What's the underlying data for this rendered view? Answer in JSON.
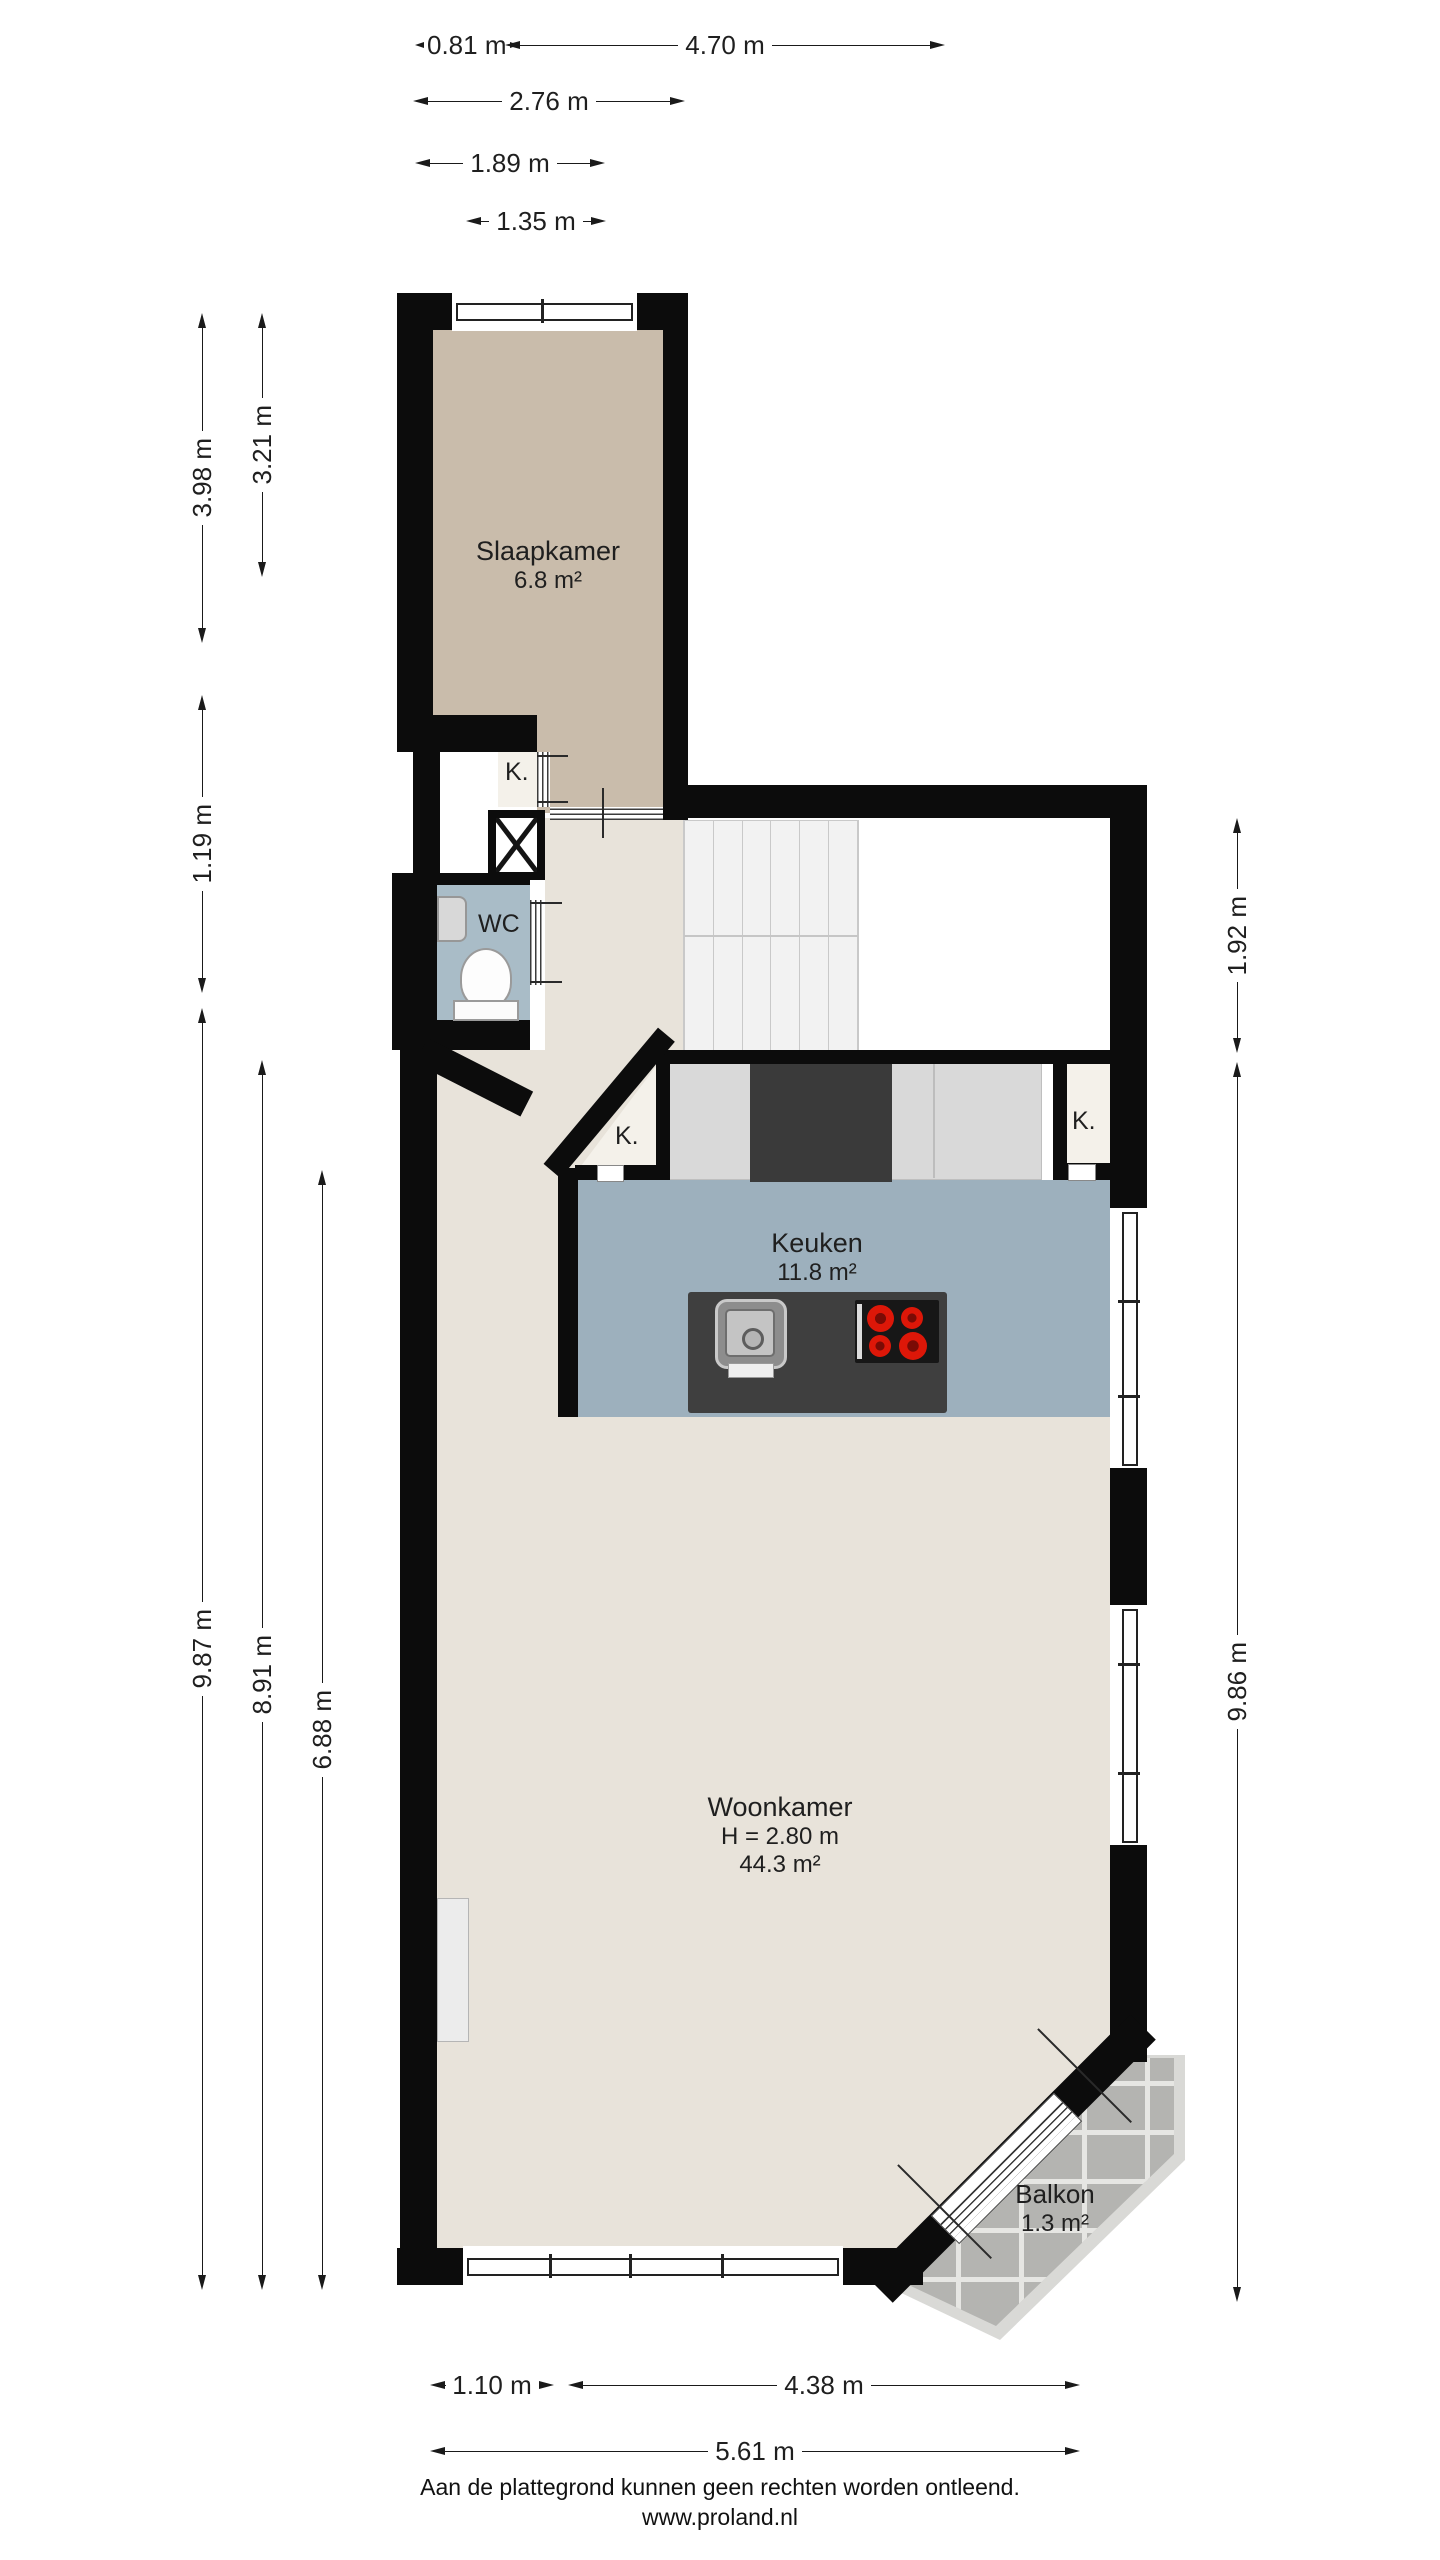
{
  "rooms": {
    "slaapkamer": {
      "name": "Slaapkamer",
      "area": "6.8 m²"
    },
    "wc": {
      "name": "WC"
    },
    "keuken": {
      "name": "Keuken",
      "area": "11.8 m²"
    },
    "woonkamer": {
      "name": "Woonkamer",
      "height": "H = 2.80 m",
      "area": "44.3 m²"
    },
    "balkon": {
      "name": "Balkon",
      "area": "1.3 m²"
    },
    "closets": {
      "hall": "K.",
      "kitchen_left": "K.",
      "kitchen_right": "K."
    }
  },
  "dimensions": {
    "top": [
      {
        "label": "0.81 m"
      },
      {
        "label": "4.70 m"
      },
      {
        "label": "2.76 m"
      },
      {
        "label": "1.89 m"
      },
      {
        "label": "1.35 m"
      }
    ],
    "left": [
      {
        "label": "3.98 m"
      },
      {
        "label": "3.21 m"
      },
      {
        "label": "1.19 m"
      },
      {
        "label": "9.87 m"
      },
      {
        "label": "8.91 m"
      },
      {
        "label": "6.88 m"
      }
    ],
    "right": [
      {
        "label": "1.92 m"
      },
      {
        "label": "9.86 m"
      }
    ],
    "bottom": [
      {
        "label": "1.10 m"
      },
      {
        "label": "4.38 m"
      },
      {
        "label": "5.61 m"
      }
    ]
  },
  "footer": {
    "disclaimer": "Aan de plattegrond kunnen geen rechten worden ontleend.",
    "website": "www.proland.nl"
  },
  "colors": {
    "wall": "#0c0c0c",
    "bedroom_floor": "#c9bcab",
    "living_floor": "#e8e3da",
    "kitchen_floor": "#9db0bd",
    "wc_floor": "#a9bcc7",
    "closet_floor": "#f4f1ea",
    "counter": "#d9d9d9",
    "dark_unit": "#3a3a3a",
    "balcony_tile": "#b4b4b1",
    "burner_red": "#dd1708"
  }
}
